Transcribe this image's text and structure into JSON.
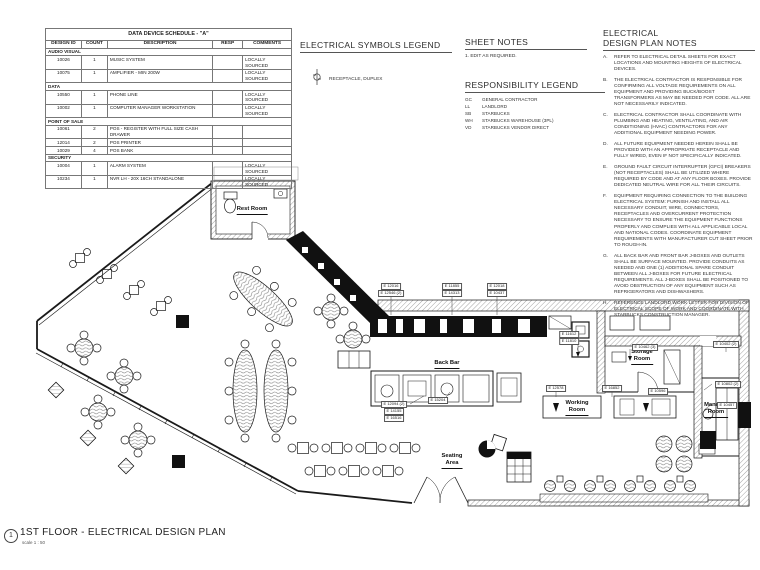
{
  "sheet": {
    "number": "1",
    "title": "1ST FLOOR - ELECTRICAL DESIGN PLAN",
    "scale": "scale 1 : 50",
    "line_color": "#1a1a1a",
    "background": "#ffffff"
  },
  "schedule": {
    "title": "DATA DEVICE SCHEDULE - \"A\"",
    "columns": [
      "DESIGN ID",
      "COUNT",
      "DESCRIPTION",
      "RESP",
      "COMMENTS"
    ],
    "sections": [
      {
        "name": "AUDIO VISUAL",
        "rows": [
          [
            "10026",
            "1",
            "MUSIC SYSTEM",
            "",
            "LOCALLY SOURCED"
          ],
          [
            "10075",
            "1",
            "AMPLIFIER - MIN 200W",
            "",
            "LOCALLY SOURCED"
          ]
        ]
      },
      {
        "name": "DATA",
        "rows": [
          [
            "10550",
            "1",
            "PHONE LINE",
            "",
            "LOCALLY SOURCED"
          ],
          [
            "10002",
            "1",
            "COMPUTER MANAGER WORKSTATION",
            "",
            "LOCALLY SOURCED"
          ]
        ]
      },
      {
        "name": "POINT OF SALE",
        "rows": [
          [
            "10061",
            "2",
            "POS - REGISTER WITH FULL SIZE CASH DRAWER",
            "",
            ""
          ],
          [
            "12014",
            "2",
            "POS PRINTER",
            "",
            ""
          ],
          [
            "10029",
            "4",
            "POS BANK",
            "",
            ""
          ]
        ]
      },
      {
        "name": "SECURITY",
        "rows": [
          [
            "10004",
            "1",
            "ALARM SYSTEM",
            "",
            "LOCALLY SOURCED"
          ],
          [
            "10234",
            "1",
            "NVR LH - 20X 16CH STANDALONE",
            "",
            "LOCALLY SOURCED"
          ]
        ]
      }
    ]
  },
  "symbols_legend": {
    "title": "ELECTRICAL SYMBOLS LEGEND",
    "items": [
      {
        "symbol": "duplex-receptacle",
        "label": "RECEPTACLE, DUPLEX"
      }
    ]
  },
  "sheet_notes": {
    "title": "SHEET NOTES",
    "items": [
      "1.   EDIT AS REQUIRED."
    ]
  },
  "responsibility": {
    "title": "RESPONSIBILITY LEGEND",
    "items": [
      {
        "abbr": "GC",
        "label": "GENERAL CONTRACTOR"
      },
      {
        "abbr": "LL",
        "label": "LANDLORD"
      },
      {
        "abbr": "SB",
        "label": "STARBUCKS"
      },
      {
        "abbr": "WH",
        "label": "STARBUCKS WAREHOUSE (3PL)"
      },
      {
        "abbr": "VD",
        "label": "STARBUCKS VENDOR DIRECT"
      }
    ]
  },
  "design_notes": {
    "title_line1": "ELECTRICAL",
    "title_line2": "DESIGN PLAN NOTES",
    "items": [
      {
        "letter": "A.",
        "text": "REFER TO ELECTRICAL DETAIL SHEETS FOR EXACT LOCATIONS AND MOUNTING HEIGHTS OF ELECTRICAL DEVICES."
      },
      {
        "letter": "B.",
        "text": "THE ELECTRICAL CONTRACTOR IS RESPONSIBLE FOR CONFIRMING ALL VOLTAGE REQUIREMENTS ON ALL EQUIPMENT AND PROVIDING BUCK/BOOST TRANSFORMERS AS MAY BE NEEDED FOR CODE.  ALL ARE NOT NECESSARILY INDICATED."
      },
      {
        "letter": "C.",
        "text": "ELECTRICAL CONTRACTOR SHALL COORDINATE WITH PLUMBING AND HEATING, VENTILATING, AND AIR CONDITIONING (HVAC) CONTRACTORS FOR ANY ADDITIONAL EQUIPMENT NEEDING POWER."
      },
      {
        "letter": "D.",
        "text": "ALL FUTURE EQUIPMENT NEEDED HEREIN SHALL BE PROVIDED WITH AN APPROPRIATE RECEPTACLE AND FULLY WIRED, EVEN IF NOT SPECIFICALLY INDICATED."
      },
      {
        "letter": "E.",
        "text": "GROUND FAULT CIRCUIT INTERRUPTER (GFCI) BREAKERS (NOT RECEPTACLES) SHALL BE UTILIZED WHERE REQUIRED BY CODE AND AT ANY FLOOR BOXES.  PROVIDE DEDICATED NEUTRAL WIRE FOR ALL THEIR CIRCUITS."
      },
      {
        "letter": "F.",
        "text": "EQUIPMENT REQUIRING CONNECTION TO THE BUILDING ELECTRICAL SYSTEM:  FURNISH AND INSTALL ALL NECESSARY CONDUIT, WIRE, CONNECTORS, RECEPTACLES AND OVERCURRENT PROTECTION NECESSARY TO ENSURE THE EQUIPMENT FUNCTIONS PROPERLY AND COMPLIES WITH ALL APPLICABLE LOCAL AND NATIONAL CODES.  COORDINATE EQUIPMENT REQUIREMENTS WITH MANUFACTURER CUT SHEET PRIOR TO ROUGH-IN."
      },
      {
        "letter": "G.",
        "text": "ALL BACK BAR AND FRONT BAR J-BOXES AND OUTLETS SHALL BE SURFACE MOUNTED.  PROVIDE CONDUITS AS NEEDED AND ONE (1) ADDITIONAL SPARE CONDUIT BETWEEN ALL J-BOXES FOR FUTURE ELECTRICAL REQUIREMENTS.  ALL J-BOXES SHALL BE POSITIONED TO AVOID OBSTRUCTION OF ANY EQUIPMENT SUCH AS REFRIGERATORS AND DISHWASHERS."
      },
      {
        "letter": "H.",
        "text": "REFERENCE LANDLORD WORK LETTER FOR DIVISION OF ELECTRICAL SCOPE OF WORK AND COORDINATE WITH STARBUCKS CONSTRUCTION MANAGER."
      }
    ]
  },
  "plan": {
    "room_labels": [
      {
        "id": "rest-room",
        "lines": [
          "Rest Room"
        ],
        "x": 252,
        "y": 206
      },
      {
        "id": "back-bar",
        "lines": [
          "Back Bar"
        ],
        "x": 447,
        "y": 360
      },
      {
        "id": "storage-room",
        "lines": [
          "Storage",
          "Room"
        ],
        "x": 642,
        "y": 349
      },
      {
        "id": "working-room",
        "lines": [
          "Working",
          "Room"
        ],
        "x": 577,
        "y": 400
      },
      {
        "id": "manager-room",
        "lines": [
          "Manager",
          "Room"
        ],
        "x": 716,
        "y": 402
      },
      {
        "id": "seating-area",
        "lines": [
          "Seating",
          "Area"
        ],
        "x": 452,
        "y": 453
      }
    ],
    "tags": [
      {
        "x": 391,
        "y": 283,
        "lines": [
          "E 12016",
          "E 12546 (2)"
        ]
      },
      {
        "x": 452,
        "y": 283,
        "lines": [
          "E 11855",
          "E 14313"
        ]
      },
      {
        "x": 497,
        "y": 283,
        "lines": [
          "E 12018",
          "E 10437"
        ]
      },
      {
        "x": 569,
        "y": 331,
        "lines": [
          "E 11612",
          "E 11810"
        ]
      },
      {
        "x": 645,
        "y": 344,
        "lines": [
          "E 10462 (3)"
        ]
      },
      {
        "x": 726,
        "y": 341,
        "lines": [
          "E 10402 (2)"
        ]
      },
      {
        "x": 394,
        "y": 401,
        "lines": [
          "E 12094 (2)",
          "E 14155",
          "E 16516"
        ]
      },
      {
        "x": 438,
        "y": 397,
        "lines": [
          "E 15204"
        ]
      },
      {
        "x": 556,
        "y": 385,
        "lines": [
          "E 12578"
        ]
      },
      {
        "x": 612,
        "y": 385,
        "lines": [
          "E 16852"
        ]
      },
      {
        "x": 658,
        "y": 388,
        "lines": [
          "E 10596"
        ]
      },
      {
        "x": 728,
        "y": 381,
        "lines": [
          "E 10802 (2)"
        ]
      },
      {
        "x": 727,
        "y": 402,
        "lines": [
          "E 10457"
        ]
      }
    ]
  }
}
